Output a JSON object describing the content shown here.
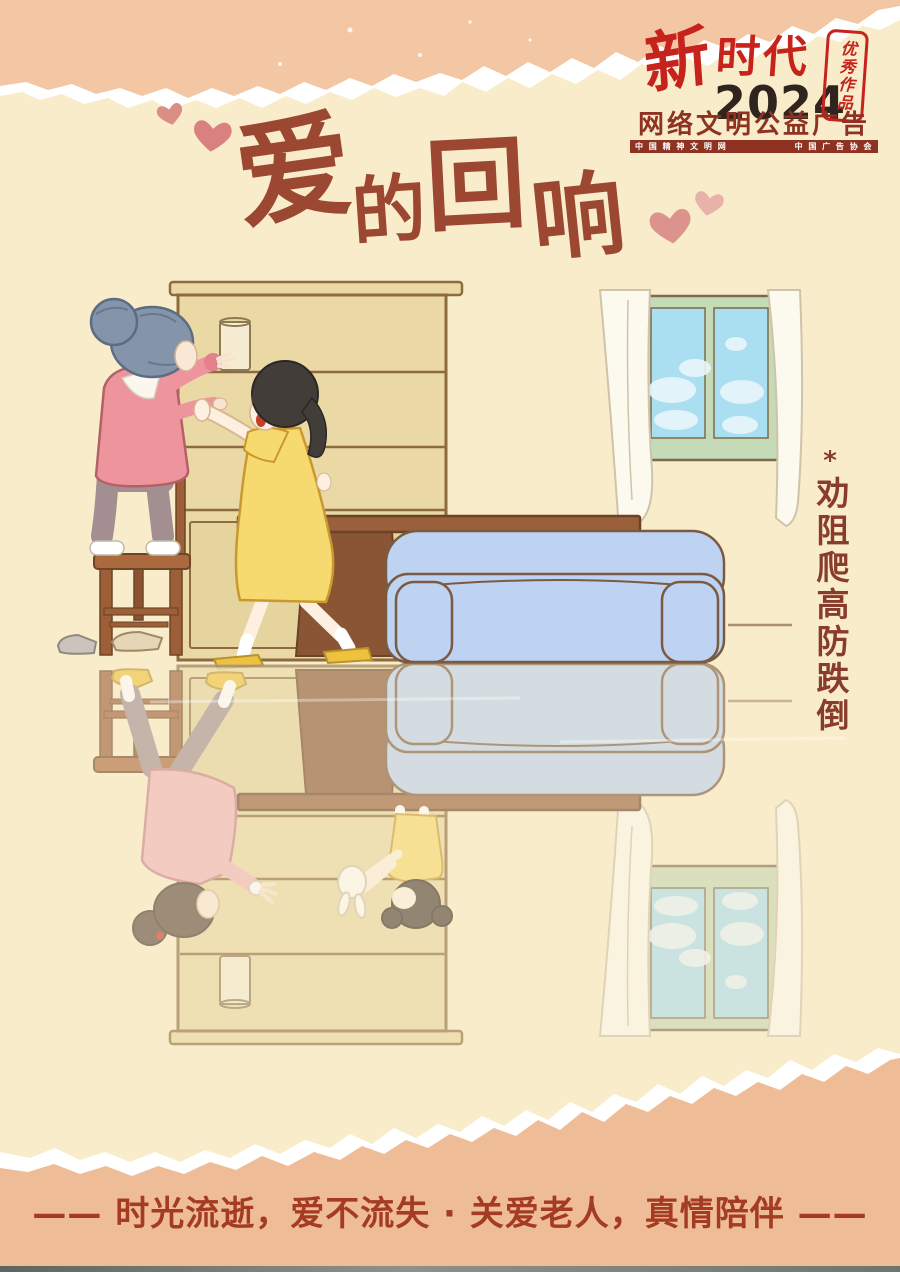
{
  "badge": {
    "brand_calligraphy": "新",
    "brand_rest": "时代",
    "year": "2024",
    "seal_vertical": "优秀作品",
    "subtitle": "网络文明公益广告",
    "org_left": "中 国 精 神 文 明 网",
    "org_right": "中 国 广 告 协 会"
  },
  "title": {
    "chars": [
      "爱",
      "的",
      "回",
      "响"
    ]
  },
  "side_note": {
    "mark": "*",
    "text": "劝阻爬高防跌倒"
  },
  "slogan": {
    "dash_left": "—— ",
    "text": "时光流逝，爱不流失 · 关爱老人，真情陪伴",
    "dash_right": " ——"
  },
  "colors": {
    "bg_cream": "#f9ecca",
    "band_salmon": "#f3c6a4",
    "band_salmon_bottom": "#eebc97",
    "title_brown": "#9c4732",
    "logo_red": "#c5231b",
    "logo_dark": "#30241f",
    "maroon": "#8e3222",
    "slogan_red": "#a43b22",
    "note_brown": "#8a3c2c",
    "heart_pink": "#db8e86",
    "heart_pink_light": "#e8b2aa",
    "shelf_tan": "#ead9a5",
    "wood_brown": "#9c5f38",
    "table_brown": "#8a5535",
    "sofa_blue": "#bed2f2",
    "window_green": "#c5dab6",
    "sky_blue": "#aadff2",
    "grandma_pink": "#ee949c",
    "grandma_hair": "#8494ab",
    "pants_mauve": "#a38e92",
    "dress_yellow": "#f6d96f",
    "slipper_yellow": "#eec23e",
    "girl_hair": "#433d3a",
    "mother_pink": "#f2b5ba",
    "mother_hair": "#5d4b3f",
    "skin": "#fdf0e0"
  }
}
